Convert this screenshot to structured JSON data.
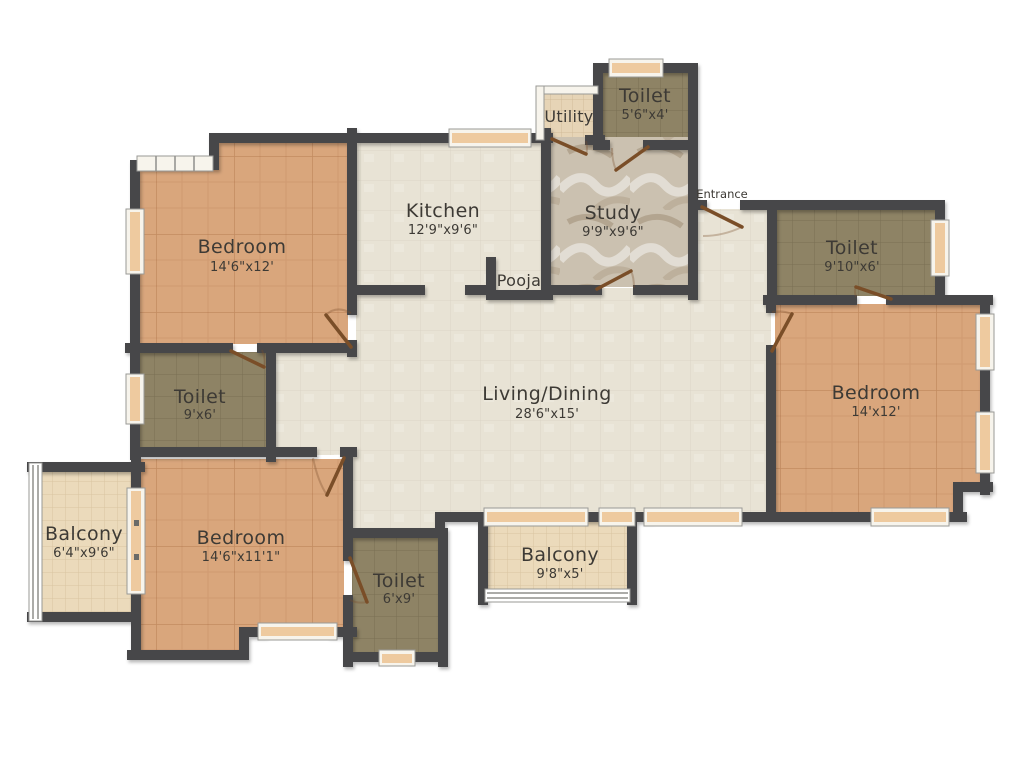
{
  "plan": {
    "rooms": [
      {
        "id": "toilet-top",
        "name": "Toilet",
        "dims": "5'6\"x4'"
      },
      {
        "id": "utility",
        "name": "Utility",
        "dims": ""
      },
      {
        "id": "kitchen",
        "name": "Kitchen",
        "dims": "12'9\"x9'6\""
      },
      {
        "id": "study",
        "name": "Study",
        "dims": "9'9\"x9'6\""
      },
      {
        "id": "toilet-right",
        "name": "Toilet",
        "dims": "9'10\"x6'"
      },
      {
        "id": "bedroom-top-left",
        "name": "Bedroom",
        "dims": "14'6\"x12'"
      },
      {
        "id": "pooja",
        "name": "Pooja",
        "dims": ""
      },
      {
        "id": "living-dining",
        "name": "Living/Dining",
        "dims": "28'6\"x15'"
      },
      {
        "id": "bedroom-right",
        "name": "Bedroom",
        "dims": "14'x12'"
      },
      {
        "id": "toilet-left",
        "name": "Toilet",
        "dims": "9'x6'"
      },
      {
        "id": "balcony-left",
        "name": "Balcony",
        "dims": "6'4\"x9'6\""
      },
      {
        "id": "bedroom-bottom",
        "name": "Bedroom",
        "dims": "14'6\"x11'1\""
      },
      {
        "id": "toilet-bottom",
        "name": "Toilet",
        "dims": "6'x9'"
      },
      {
        "id": "balcony-bottom",
        "name": "Balcony",
        "dims": "9'8\"x5'"
      }
    ],
    "annotations": {
      "entrance": "Entrance"
    }
  },
  "colors": {
    "wall": "#474748",
    "floor-cream": "#e8e3d5",
    "floor-bedroom": "#d9a67c",
    "floor-toilet": "#8e8365",
    "floor-balcony": "#ebdabb",
    "floor-marble": "#cbc1b0",
    "floor-utility": "#e6d4b6",
    "window-tan": "#eeca9f",
    "door-brown": "#7a4e28",
    "label": "#3d3a35"
  }
}
